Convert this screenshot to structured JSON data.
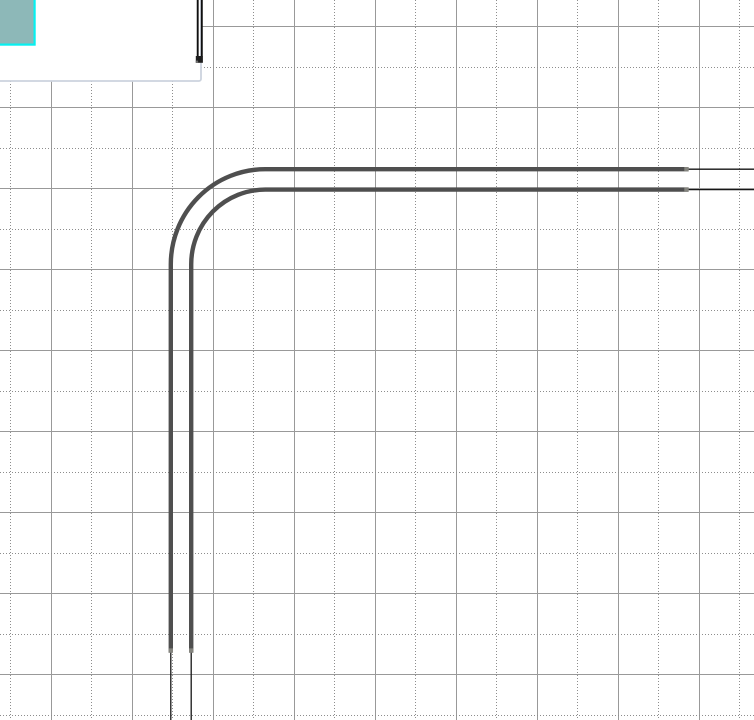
{
  "app": {
    "view": "drawing-canvas",
    "visible_text": []
  },
  "canvas": {
    "width": 754,
    "height": 720,
    "background": "#ffffff",
    "grid": {
      "cell_size": 81,
      "solid_line_color": "#999999",
      "dotted_line_color": "#8d8d8d",
      "line_width": 1,
      "dotted_dash": "1 2"
    },
    "shapes": {
      "white_panel": {
        "fill": "#ffffff",
        "border_color": "#ccd3de",
        "border_width": 1.8
      },
      "teal_box": {
        "fill": "#8db8b8",
        "border_color": "#06f0f0",
        "border_width": 2.2
      },
      "wall_segment": {
        "stroke_color": "#0f0f0f",
        "stroke_width": 1.9,
        "endpoint_fill": "#1e1e1e",
        "endpoint_notch_color": "#6e6e6e"
      },
      "duct": {
        "thick_color": "#4f4f4f",
        "thick_width": 4.4,
        "thin_color": "#161616",
        "thin_width": 1.3,
        "end_cap_color": "#84847e"
      }
    }
  }
}
